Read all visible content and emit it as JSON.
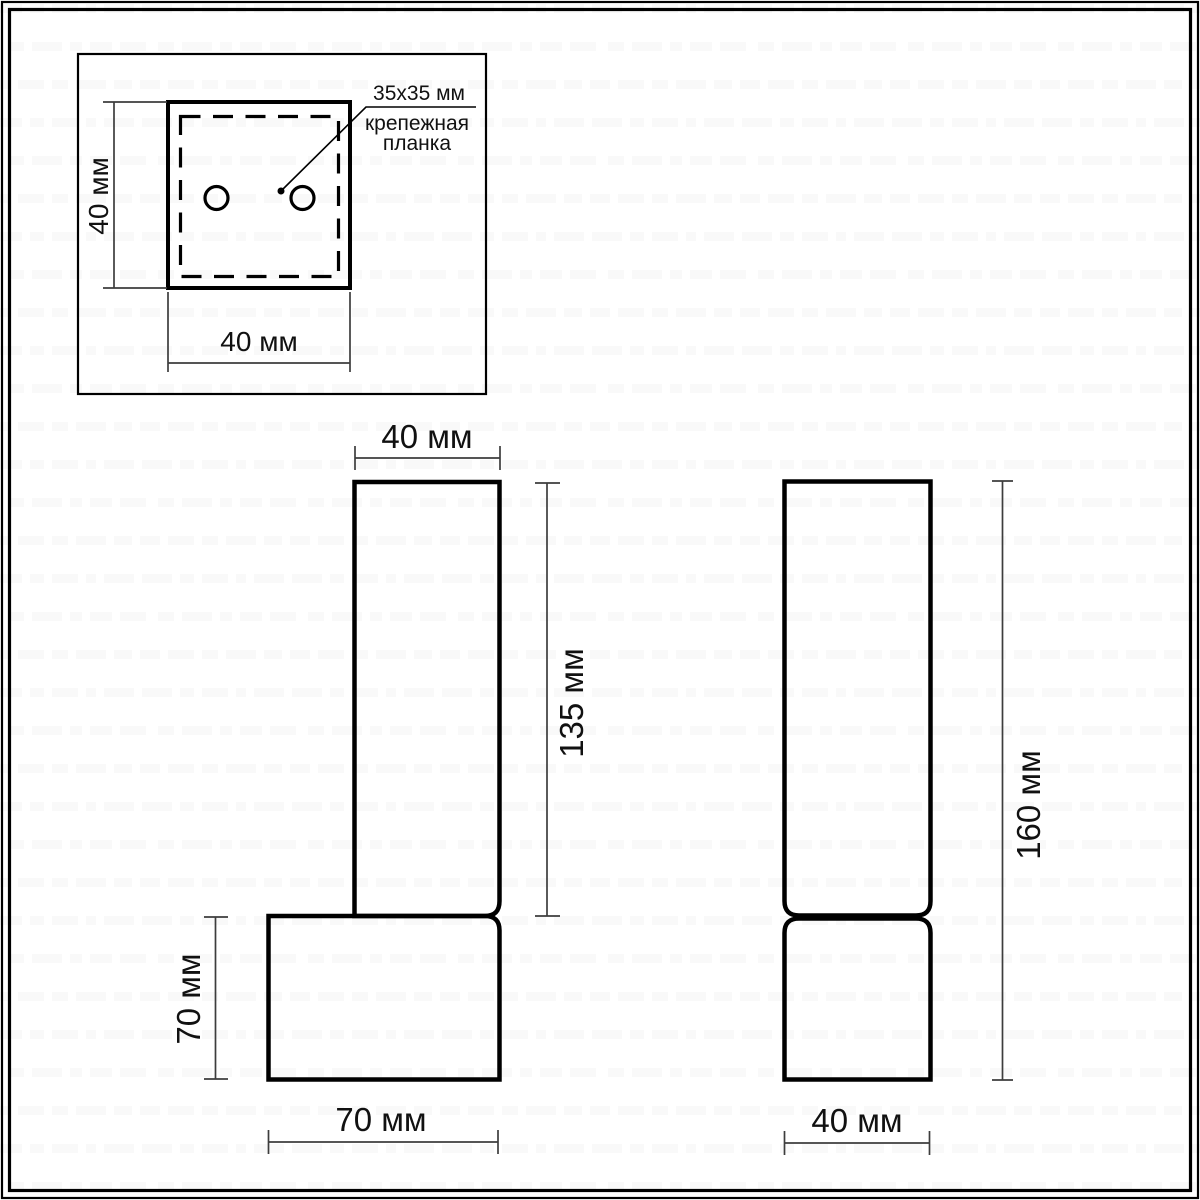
{
  "labels": {
    "top_view": {
      "height": "40 мм",
      "width": "40 мм",
      "plate_size": "35x35 мм",
      "plate_line1": "крепежная",
      "plate_line2": "планка"
    },
    "front_view": {
      "width": "40 мм",
      "tube_height": "135 мм",
      "base_height": "70 мм",
      "base_width": "70 мм"
    },
    "side_view": {
      "total_height": "160 мм",
      "width": "40 мм"
    }
  },
  "colors": {
    "line": "#000000",
    "dim": "#3d3d3d",
    "text": "#111111",
    "background": "#ffffff"
  }
}
